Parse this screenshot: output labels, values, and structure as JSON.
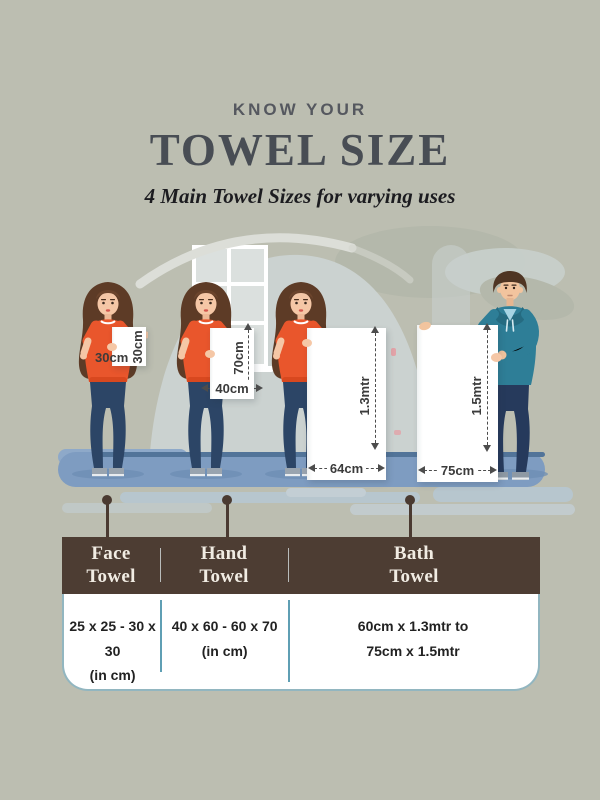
{
  "header": {
    "eyebrow": "KNOW YOUR",
    "title": "TOWEL SIZE",
    "subtitle": "4 Main Towel Sizes for varying uses"
  },
  "towels": [
    {
      "id": "face-towel",
      "person": "woman",
      "width_label": "30cm",
      "height_label": "30cm"
    },
    {
      "id": "hand-towel",
      "person": "woman",
      "width_label": "40cm",
      "height_label": "70cm"
    },
    {
      "id": "bath-towel",
      "person": "woman",
      "width_label": "64cm",
      "height_label": "1.3mtr"
    },
    {
      "id": "bath-towel-large",
      "person": "man",
      "width_label": "75cm",
      "height_label": "1.5mtr"
    }
  ],
  "table": {
    "columns": [
      {
        "header": "Face Towel",
        "size": "25 x 25 - 30 x 30",
        "unit": "(in cm)"
      },
      {
        "header": "Hand Towel",
        "size": "40 x 60 - 60 x 70",
        "unit": "(in cm)"
      },
      {
        "header": "Bath Towel",
        "size": "60cm x 1.3mtr to",
        "unit": "75cm x 1.5mtr"
      }
    ]
  },
  "colors": {
    "background": "#bcbeb1",
    "table_header_bg": "#4d3d33",
    "table_header_text": "#f1ece3",
    "divider_teal": "#5f9fb4",
    "floor_blue": "#7e9cc1",
    "shirt_orange": "#e9562c",
    "hoodie_teal": "#2e7e97",
    "towel_white": "#ffffff",
    "title_text": "#484d54",
    "connector_brown": "#4a3a31"
  }
}
